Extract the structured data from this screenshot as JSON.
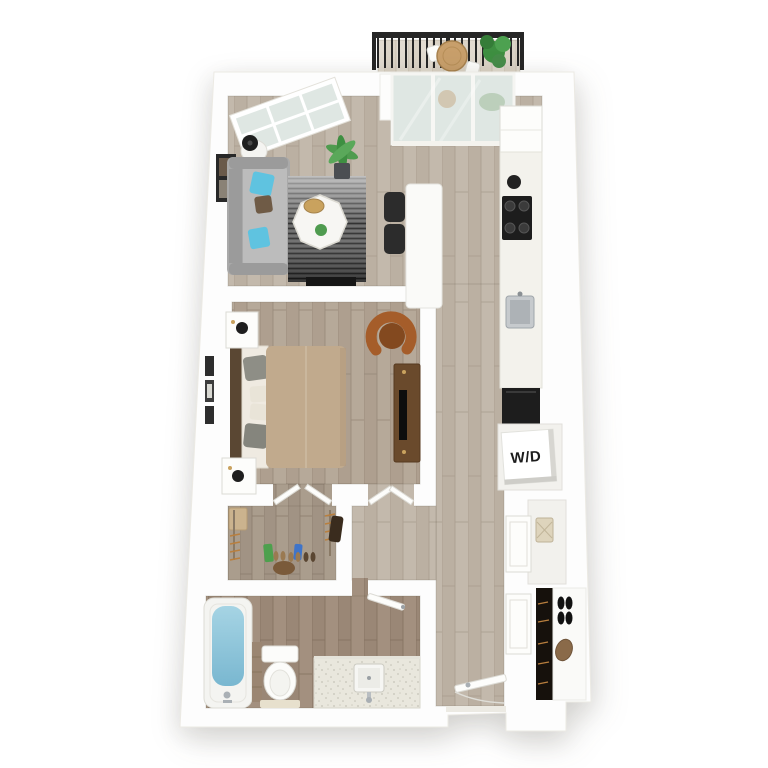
{
  "labels": {
    "washer_dryer": "W/D"
  },
  "colors": {
    "wall": "#fdfdfd",
    "wall_edge": "#eceae4",
    "floor_living": "#c3b9ac",
    "floor_living2": "#bbb0a2",
    "seam_living": "#a89d8e",
    "floor_bedroom": "#b6a999",
    "floor_bedroom2": "#ae9f8f",
    "seam_bedroom": "#97897a",
    "floor_bath": "#a3907f",
    "floor_bath2": "#9a8776",
    "seam_bath": "#84715f",
    "floor_closet": "#aa9d8d",
    "floor_closet2": "#a19384",
    "seam_closet": "#8b7d6d",
    "floor_balcony": "#e2dbd0",
    "floor_balcony2": "#dbd3c6",
    "seam_balcony": "#c8bfb0",
    "rug": "#4a4a4a",
    "rug_light": "#9a9a9a",
    "rug_dark": "#1f1f1f",
    "sofa": "#a9a9a9",
    "sofa_seat": "#bcbcbc",
    "sofa_arm": "#9b9b9b",
    "pillow_blue": "#5fc3e0",
    "pillow_brown": "#6f5b46",
    "island": "#fafaf8",
    "chair": "#2c2c2c",
    "counter": "#f3f2ec",
    "appliance": "#1d1d1d",
    "steel": "#c6cacd",
    "water_light": "#a6d4e4",
    "water_dark": "#79b7d0",
    "comforter": "#c1aa8d",
    "headboard": "#5a4733",
    "sheet": "#efeae1",
    "pillow_gray": "#8e8e86",
    "leather": "#a55d2a",
    "leather_dark": "#83491f",
    "wood": "#6a4a2c",
    "tv": "#0d0d0d",
    "plant": "#4f9b4f",
    "plant_dark": "#3e8f41",
    "pot": "#4b4e52",
    "railing": "#262626",
    "basket": "#ded4bc",
    "bag": "#8a6a49",
    "shoe": "#111111",
    "tile": "#9b8672",
    "vanity": "#e9e7dd",
    "label": "#1c1c1c",
    "gold": "#c9a25e",
    "frame": "#282828",
    "glass": "#dfe7e3",
    "door": "#fdfdfb",
    "door_edge": "#dcdbd5",
    "niche": "#f2f1ed",
    "closet_dark": "#16110c",
    "accent_tick": "#b97f3e",
    "marble": "#f7f6f3"
  },
  "scene": {
    "type": "3d-floor-plan-render",
    "view": "top-down dollhouse",
    "rooms": [
      {
        "name": "Balcony",
        "furniture": [
          "railing",
          "bistro table",
          "potted plant"
        ]
      },
      {
        "name": "Living Room",
        "furniture": [
          "sofa",
          "blue accent pillows",
          "side table with lamp",
          "wall art",
          "striped area rug",
          "octagonal coffee table",
          "potted palm",
          "media bar"
        ]
      },
      {
        "name": "Kitchen / Dining",
        "furniture": [
          "refrigerator",
          "cooktop",
          "kettle",
          "sink",
          "counter run",
          "dishwasher",
          "kitchen island",
          "two bar chairs"
        ]
      },
      {
        "name": "Bedroom",
        "furniture": [
          "bed",
          "headboard",
          "nightstand with lamp",
          "nightstand with lamp",
          "accent chair",
          "media console with tv",
          "wall frames"
        ]
      },
      {
        "name": "Walk-in Closet",
        "furniture": [
          "hanging rods",
          "clothes",
          "storage box",
          "shoes",
          "boots"
        ]
      },
      {
        "name": "Bathroom",
        "furniture": [
          "bathtub",
          "toilet",
          "vanity with sink",
          "door"
        ]
      },
      {
        "name": "Laundry Closet",
        "furniture": [
          "stacked washer-dryer cube"
        ]
      },
      {
        "name": "Entry Hall",
        "furniture": [
          "entry door",
          "closet doors",
          "basket niche",
          "coat closet with shoes and bag"
        ]
      }
    ]
  }
}
